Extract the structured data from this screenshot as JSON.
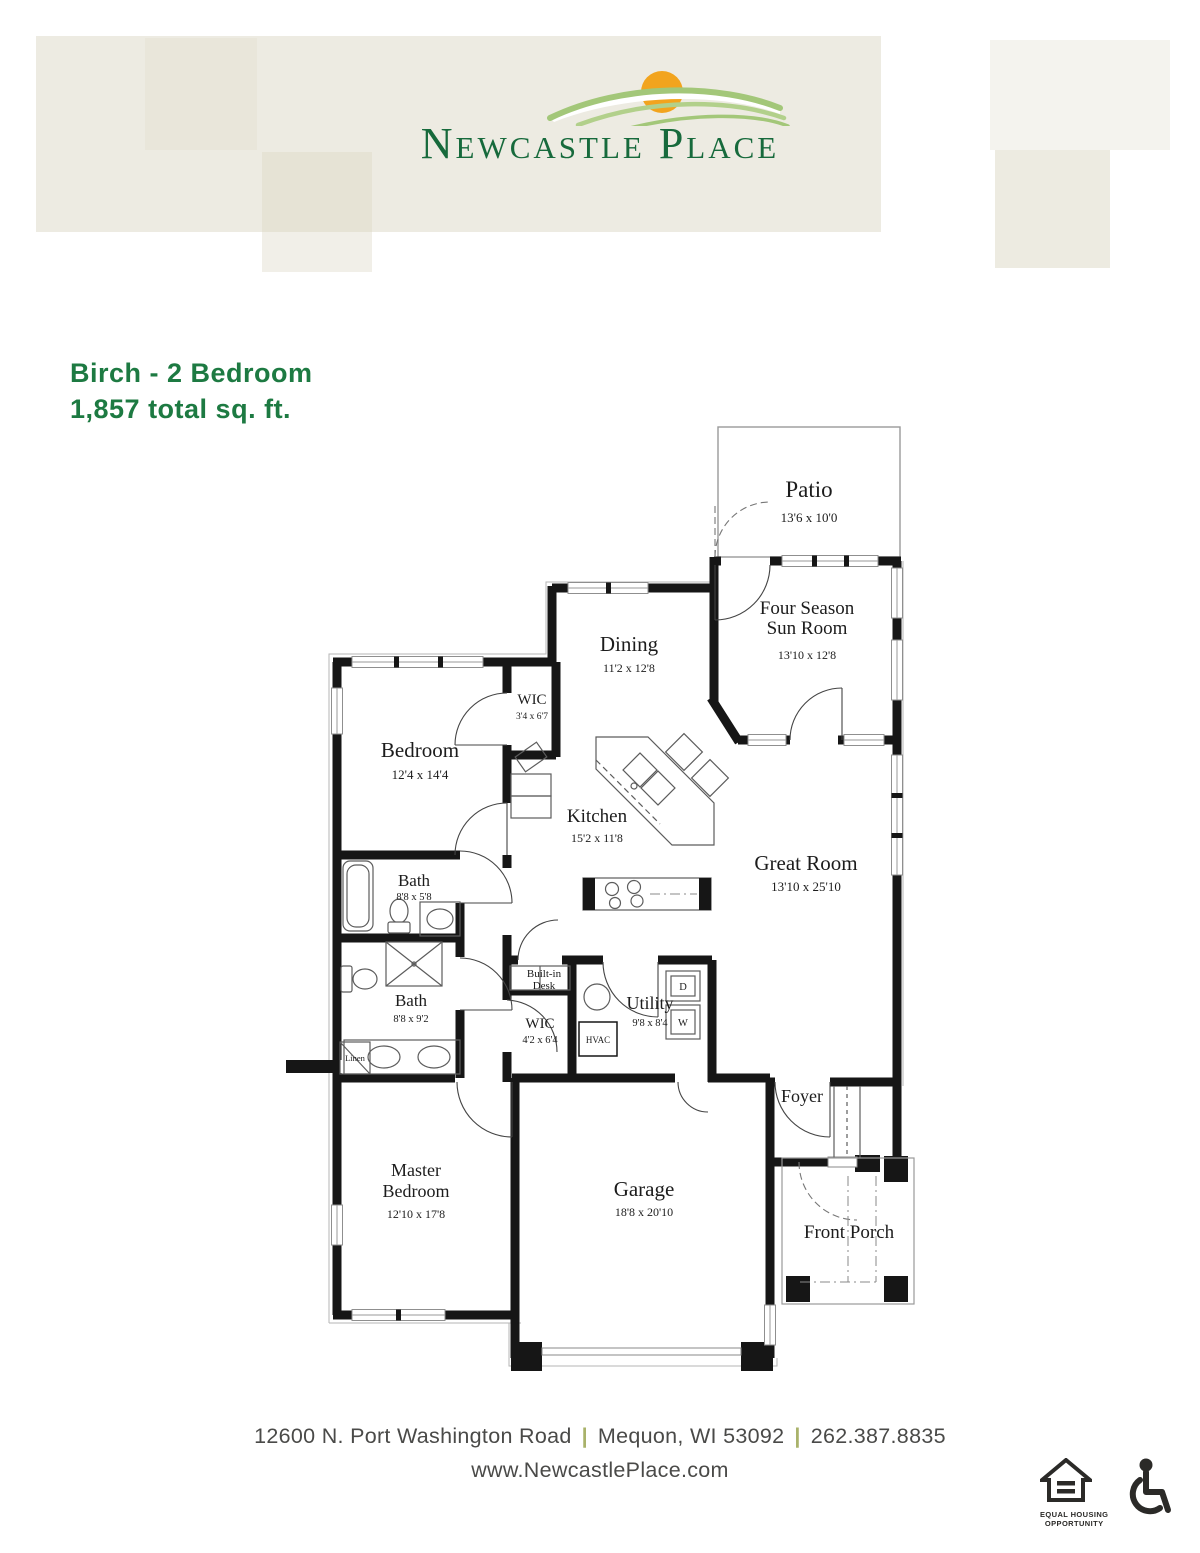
{
  "logo": {
    "name": "Newcastle Place",
    "text_color": "#176a3c",
    "sun_color": "#f2a41e",
    "swoosh_color": "#a3c779"
  },
  "title": {
    "line1": "Birch - 2 Bedroom",
    "line2": "1,857 total sq. ft.",
    "color": "#1d7a42"
  },
  "floorplan": {
    "rooms": [
      {
        "label": "Patio",
        "dims": "13'6 x 10'0"
      },
      {
        "label": "Four Season",
        "label2": "Sun Room",
        "dims": "13'10 x 12'8"
      },
      {
        "label": "Dining",
        "dims": "11'2 x 12'8"
      },
      {
        "label": "WIC",
        "dims": "3'4 x 6'7"
      },
      {
        "label": "Bedroom",
        "dims": "12'4 x 14'4"
      },
      {
        "label": "Kitchen",
        "dims": "15'2 x 11'8"
      },
      {
        "label": "Great Room",
        "dims": "13'10 x 25'10"
      },
      {
        "label": "Bath",
        "dims": "8'8 x 5'8"
      },
      {
        "label": "Bath",
        "dims": "8'8 x 9'2"
      },
      {
        "label": "Built-in",
        "label2": "Desk"
      },
      {
        "label": "WIC",
        "dims": "4'2 x 6'4"
      },
      {
        "label": "HVAC"
      },
      {
        "label": "Utility",
        "dims": "9'8 x 8'4"
      },
      {
        "label": "D"
      },
      {
        "label": "W"
      },
      {
        "label": "Linen"
      },
      {
        "label": "Foyer"
      },
      {
        "label": "Master",
        "label2": "Bedroom",
        "dims": "12'10 x 17'8"
      },
      {
        "label": "Garage",
        "dims": "18'8 x 20'10"
      },
      {
        "label": "Front Porch"
      }
    ]
  },
  "footer": {
    "address": "12600 N. Port Washington Road",
    "city": "Mequon, WI 53092",
    "phone": "262.387.8835",
    "separator": "|",
    "separator_color": "#a9b26a",
    "website": "www.NewcastlePlace.com"
  },
  "badges": {
    "equal_housing_line1": "EQUAL HOUSING",
    "equal_housing_line2": "OPPORTUNITY"
  }
}
